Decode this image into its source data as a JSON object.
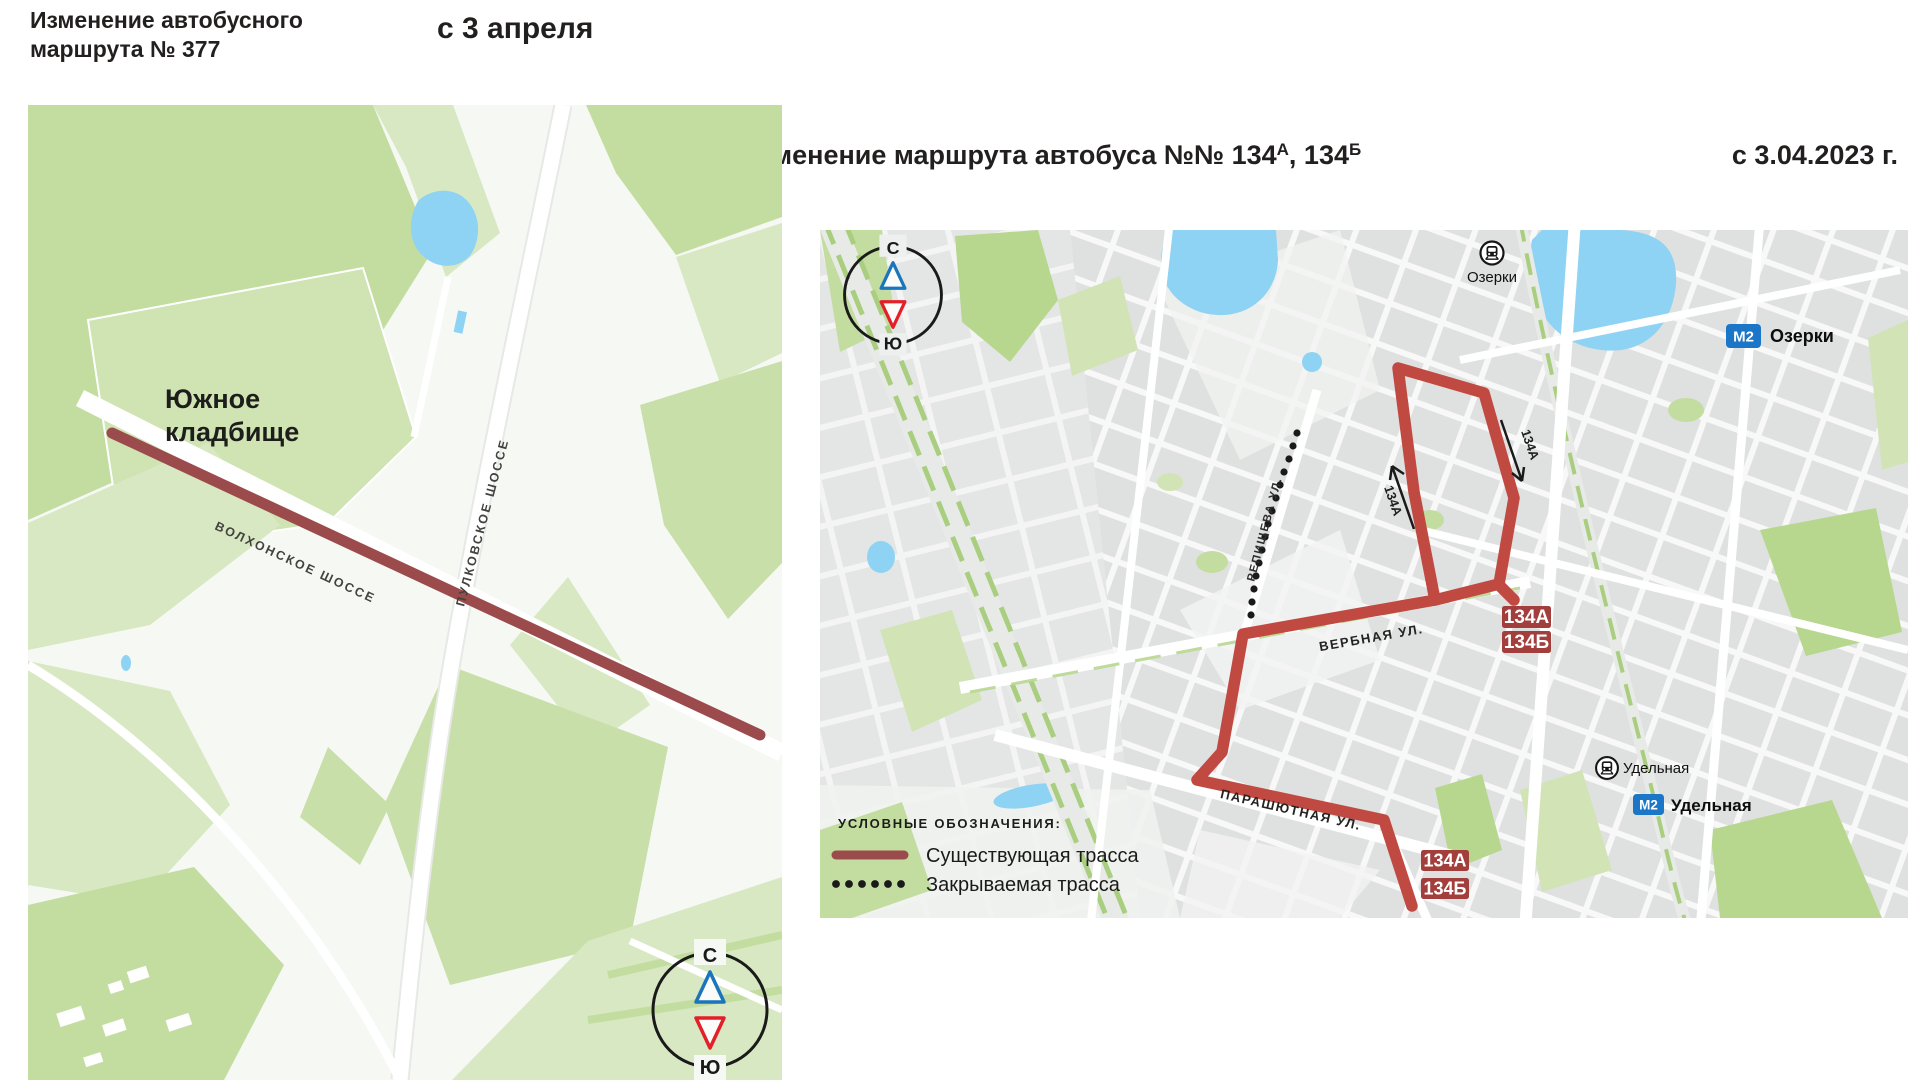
{
  "left_panel": {
    "title_line1": "Изменение автобусного",
    "title_line2": "маршрута № 377",
    "effective_date": "с 3 апреля",
    "map": {
      "place_line1": "Южное",
      "place_line2": "кладбище",
      "road_volkhonskoe": "ВОЛХОНСКОЕ ШОССЕ",
      "road_pulkovskoe": "ПУЛКОВСКОЕ ШОССЕ",
      "compass_north": "С",
      "compass_south": "Ю"
    }
  },
  "right_panel": {
    "title_main": "Изменение маршрута автобуса №№ 134",
    "title_sup_a": "А",
    "title_separator": ", 134",
    "title_sup_b": "Б",
    "effective_date": "с 3.04.2023 г.",
    "map": {
      "compass_north": "С",
      "compass_south": "Ю",
      "rail_station_ozerki": "Озерки",
      "metro_station_ozerki": "Озерки",
      "rail_station_udelnaya": "Удельная",
      "metro_station_udelnaya": "Удельная",
      "metro_line_badge": "М2",
      "street_repishcheva": "РЕПИЩЕВА УЛ.",
      "street_verbnaya": "ВЕРБНАЯ УЛ.",
      "street_parashyutnaya": "ПАРАШЮТНАЯ УЛ.",
      "route_badge_a": "134А",
      "route_badge_b": "134Б",
      "direction_label": "134А",
      "legend_title": "УСЛОВНЫЕ ОБОЗНАЧЕНИЯ:",
      "legend_existing": "Существующая трасса",
      "legend_closing": "Закрываемая трасса"
    }
  },
  "colors": {
    "route_existing": "#c04a41",
    "route_377": "#9c4b4c",
    "badge_red": "#a23f3c",
    "metro_blue": "#1b76c8",
    "compass_north_blue": "#1b75bb",
    "compass_south_red": "#e3202a",
    "water": "#8ed3f3",
    "green_mid": "#c3dda1",
    "green_pale": "#d8e8c2",
    "text_dark": "#221f1f"
  }
}
